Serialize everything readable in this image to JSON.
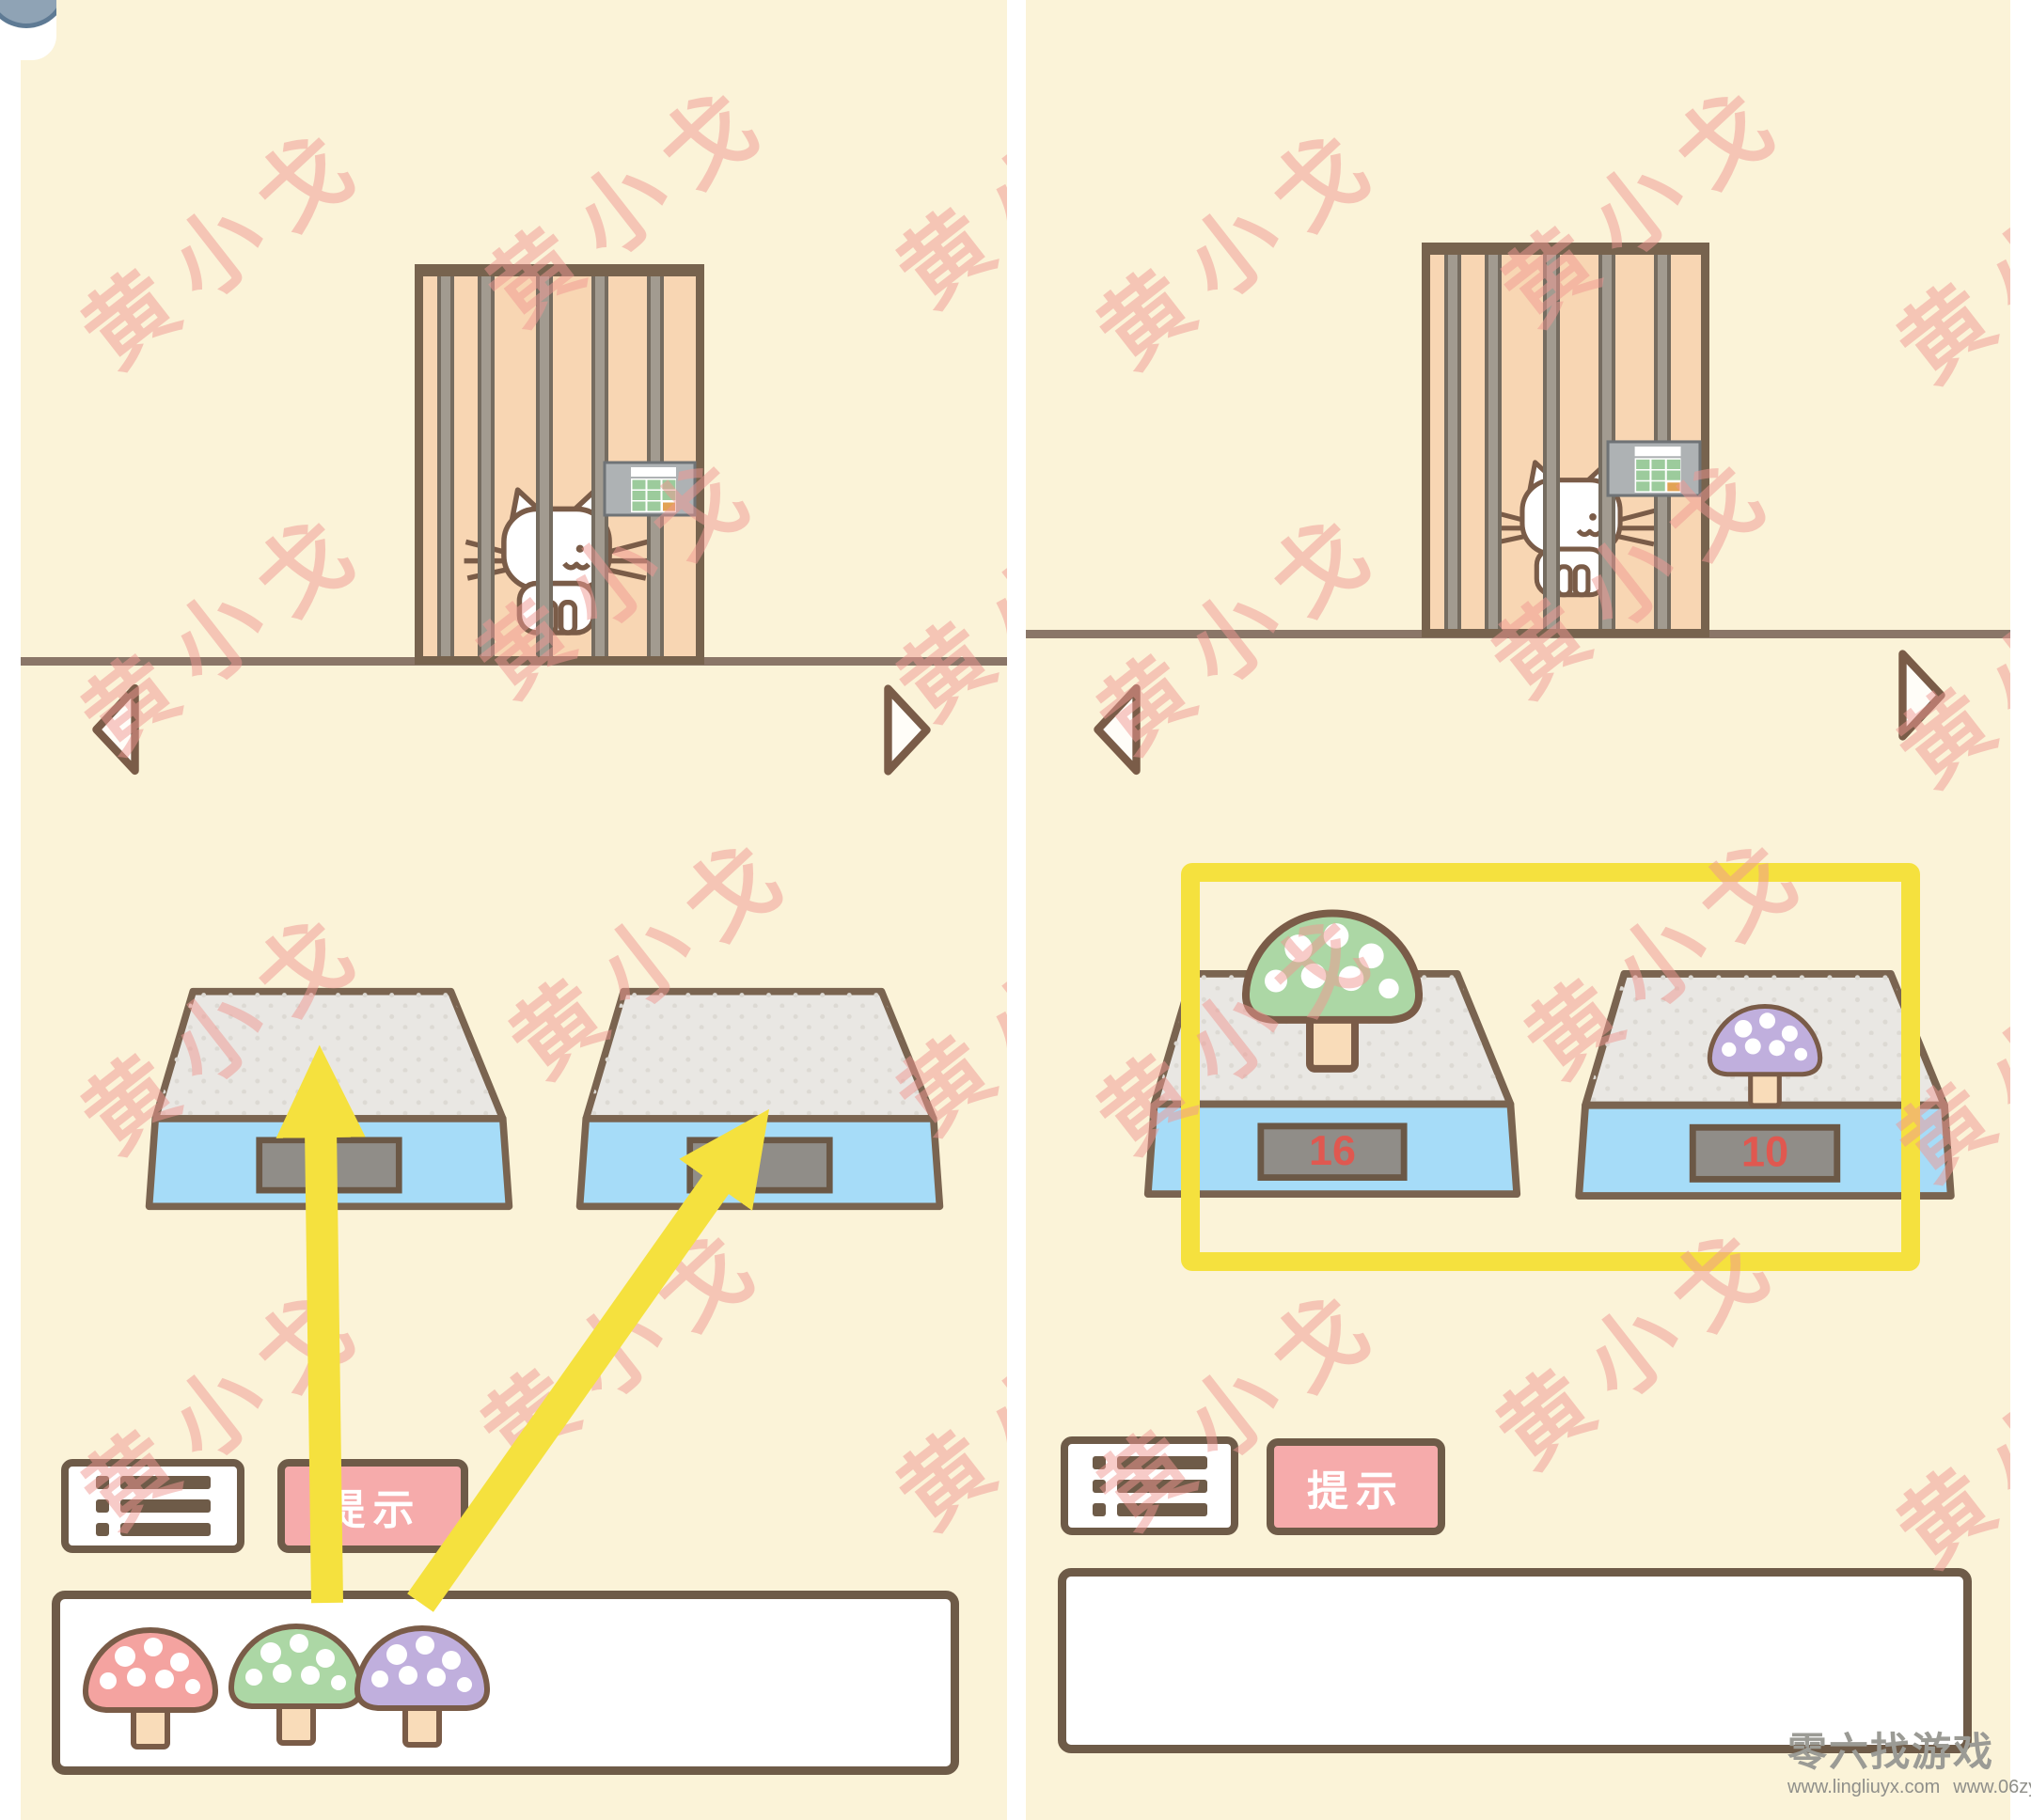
{
  "watermark": {
    "text": "黄小戈",
    "color": "rgba(240,152,146,0.5)"
  },
  "colors": {
    "background_cream": "#FBF3D8",
    "outline_brown": "#7A6450",
    "highlight_yellow": "#F5E13E",
    "scale_base_blue": "#A6DCF8",
    "scale_platform_gray": "#E9E7E3",
    "hint_pink": "#F6ABAB",
    "display_red": "#E05850",
    "cage_peach": "#F8D6B3"
  },
  "shared": {
    "stem_color": "#F9DCB9",
    "dot_color": "#FFFFFF"
  },
  "left_panel": {
    "hint_button_label": "提示",
    "scales": [
      {
        "value": ""
      },
      {
        "value": ""
      }
    ],
    "inventory_mushrooms": [
      {
        "name": "pink-mushroom",
        "cap_color": "#F4A3A0"
      },
      {
        "name": "green-mushroom",
        "cap_color": "#ACD7A5"
      },
      {
        "name": "purple-mushroom",
        "cap_color": "#C0AFDD"
      }
    ]
  },
  "right_panel": {
    "hint_button_label": "提示",
    "scales": [
      {
        "value": "16",
        "mushroom": "green-mushroom",
        "cap_color": "#ACD7A5"
      },
      {
        "value": "10",
        "mushroom": "purple-mushroom",
        "cap_color": "#C0AFDD"
      }
    ]
  },
  "footer": {
    "brand": "零六找游戏",
    "url_left": "www.lingliuyx.com",
    "url_right": "www.06zyx.com"
  }
}
